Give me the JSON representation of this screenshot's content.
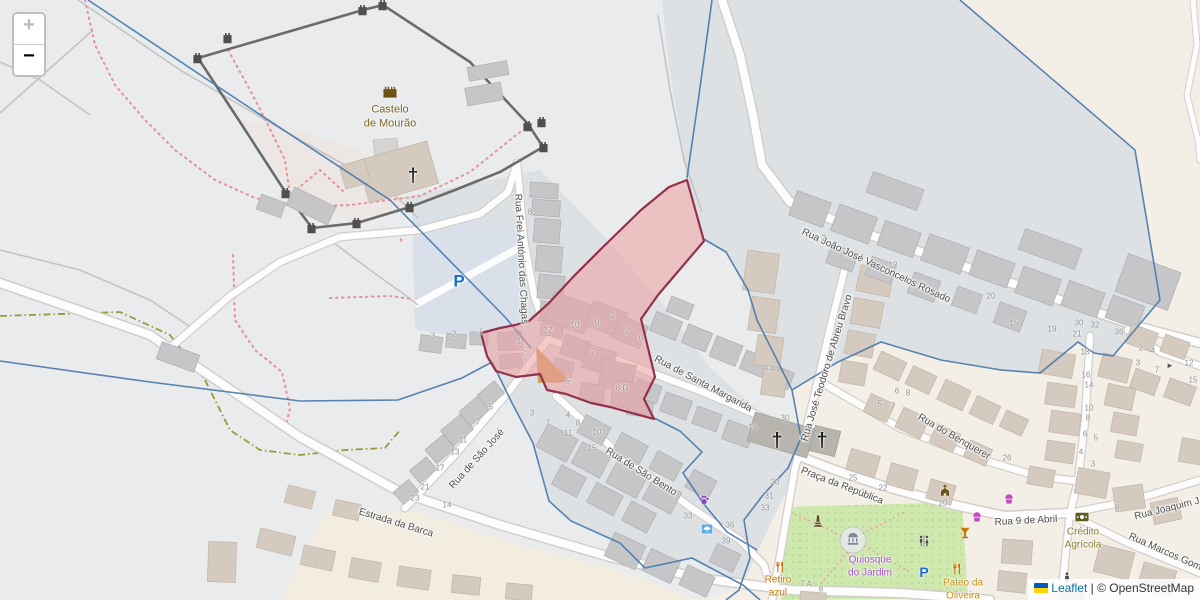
{
  "ui": {
    "controls": {
      "zoom_in": "+",
      "zoom_out": "−"
    },
    "attribution": {
      "leaflet": "Leaflet",
      "separator": " | ",
      "osm": "© OpenStreetMap",
      "flag_icon": "ukraine-flag-icon"
    }
  },
  "map": {
    "colors": {
      "selection_fill": "#ee9f9f",
      "selection_stroke": "#93304c",
      "boundary_blue": "#4a79ad",
      "park_green": "#cfe8ae",
      "road_white": "#fdfdfd",
      "landuse_gray": "#dde1e4",
      "landuse_cream": "#f4efe6"
    },
    "street_labels": [
      {
        "text": "Rua Frei António das Chagas",
        "x": 521,
        "y": 259,
        "rot": 87
      },
      {
        "text": "Rua de Santa Margarida",
        "x": 703,
        "y": 384,
        "rot": 28
      },
      {
        "text": "Rua João José Vasconcelos Rosado",
        "x": 876,
        "y": 266,
        "rot": 25
      },
      {
        "text": "Rua José Teodoro de Abreu Bravo",
        "x": 827,
        "y": 368,
        "rot": -73
      },
      {
        "text": "Rua do Benquerer",
        "x": 954,
        "y": 437,
        "rot": 30
      },
      {
        "text": "Rua de São José",
        "x": 477,
        "y": 459,
        "rot": -48
      },
      {
        "text": "Rua de São Bento",
        "x": 641,
        "y": 472,
        "rot": 32
      },
      {
        "text": "Estrada da Barca",
        "x": 396,
        "y": 523,
        "rot": 17
      },
      {
        "text": "Praça da República",
        "x": 842,
        "y": 486,
        "rot": 21
      },
      {
        "text": "Rua 9 de Abril",
        "x": 1026,
        "y": 521,
        "rot": -3
      },
      {
        "text": "Rua Joaquim J",
        "x": 1167,
        "y": 509,
        "rot": -14
      },
      {
        "text": "Rua Marcos Gom",
        "x": 1165,
        "y": 552,
        "rot": 24
      }
    ],
    "poi_labels": [
      {
        "name": "castle-label",
        "text": "Castelo\nde Mourão",
        "x": 390,
        "y": 117,
        "color": "#7b6428",
        "size": 11
      },
      {
        "name": "bank-label",
        "text": "Crédito\nAgrícola",
        "x": 1083,
        "y": 539,
        "color": "#8b7d33",
        "size": 10
      },
      {
        "name": "kiosk-label",
        "text": "Quiosque\ndo Jardim",
        "x": 870,
        "y": 567,
        "color": "#a050c8",
        "size": 10
      },
      {
        "name": "restaurant-label",
        "text": "Retiro\nazul",
        "x": 778,
        "y": 587,
        "color": "#c77400",
        "size": 10
      },
      {
        "name": "restaurant-label",
        "text": "Pateo da\nOliveira",
        "x": 963,
        "y": 590,
        "color": "#c98e13",
        "size": 10
      }
    ],
    "house_numbers": [
      {
        "t": "1",
        "x": 531,
        "y": 193
      },
      {
        "t": "8",
        "x": 530,
        "y": 212
      },
      {
        "t": "12",
        "x": 548,
        "y": 330
      },
      {
        "t": "10",
        "x": 575,
        "y": 325
      },
      {
        "t": "9",
        "x": 597,
        "y": 323
      },
      {
        "t": "1",
        "x": 613,
        "y": 315
      },
      {
        "t": "2",
        "x": 627,
        "y": 331
      },
      {
        "t": "6",
        "x": 641,
        "y": 338
      },
      {
        "t": "7",
        "x": 593,
        "y": 352
      },
      {
        "t": "5",
        "x": 568,
        "y": 381
      },
      {
        "t": "8 D",
        "x": 622,
        "y": 388
      },
      {
        "t": "1",
        "x": 519,
        "y": 341
      },
      {
        "t": "2",
        "x": 523,
        "y": 353
      },
      {
        "t": "3",
        "x": 433,
        "y": 336
      },
      {
        "t": "2",
        "x": 454,
        "y": 334
      },
      {
        "t": "1",
        "x": 481,
        "y": 332
      },
      {
        "t": "5",
        "x": 491,
        "y": 407
      },
      {
        "t": "7",
        "x": 478,
        "y": 422
      },
      {
        "t": "11",
        "x": 463,
        "y": 440
      },
      {
        "t": "13",
        "x": 455,
        "y": 452
      },
      {
        "t": "17",
        "x": 440,
        "y": 468
      },
      {
        "t": "21",
        "x": 425,
        "y": 487
      },
      {
        "t": "23",
        "x": 415,
        "y": 498
      },
      {
        "t": "14",
        "x": 447,
        "y": 505
      },
      {
        "t": "3",
        "x": 532,
        "y": 413
      },
      {
        "t": "7",
        "x": 548,
        "y": 423
      },
      {
        "t": "4",
        "x": 568,
        "y": 415
      },
      {
        "t": "8",
        "x": 578,
        "y": 423
      },
      {
        "t": "11",
        "x": 568,
        "y": 433
      },
      {
        "t": "10",
        "x": 597,
        "y": 432
      },
      {
        "t": "15",
        "x": 592,
        "y": 448
      },
      {
        "t": "33",
        "x": 688,
        "y": 516
      },
      {
        "t": "36",
        "x": 730,
        "y": 525
      },
      {
        "t": "39",
        "x": 726,
        "y": 541
      },
      {
        "t": "30",
        "x": 775,
        "y": 482
      },
      {
        "t": "31",
        "x": 769,
        "y": 496
      },
      {
        "t": "33",
        "x": 765,
        "y": 508
      },
      {
        "t": "30",
        "x": 785,
        "y": 418
      },
      {
        "t": "15",
        "x": 753,
        "y": 427
      },
      {
        "t": "2",
        "x": 824,
        "y": 238
      },
      {
        "t": "12",
        "x": 893,
        "y": 265
      },
      {
        "t": "20",
        "x": 991,
        "y": 296
      },
      {
        "t": "15",
        "x": 1014,
        "y": 323
      },
      {
        "t": "19",
        "x": 1052,
        "y": 329
      },
      {
        "t": "30",
        "x": 1079,
        "y": 323
      },
      {
        "t": "32",
        "x": 1095,
        "y": 325
      },
      {
        "t": "21",
        "x": 1077,
        "y": 334
      },
      {
        "t": "36",
        "x": 1119,
        "y": 332
      },
      {
        "t": "2",
        "x": 1141,
        "y": 348
      },
      {
        "t": "4",
        "x": 1153,
        "y": 351
      },
      {
        "t": "3",
        "x": 1138,
        "y": 363
      },
      {
        "t": "7",
        "x": 1157,
        "y": 370
      },
      {
        "t": "12",
        "x": 1189,
        "y": 363
      },
      {
        "t": "15",
        "x": 1193,
        "y": 380
      },
      {
        "t": "18",
        "x": 1085,
        "y": 352
      },
      {
        "t": "16",
        "x": 1086,
        "y": 375
      },
      {
        "t": "14",
        "x": 1089,
        "y": 385
      },
      {
        "t": "10",
        "x": 1089,
        "y": 408
      },
      {
        "t": "8",
        "x": 1088,
        "y": 418
      },
      {
        "t": "6",
        "x": 1085,
        "y": 434
      },
      {
        "t": "5",
        "x": 1096,
        "y": 438
      },
      {
        "t": "4",
        "x": 1081,
        "y": 452
      },
      {
        "t": "3",
        "x": 1093,
        "y": 464
      },
      {
        "t": "6",
        "x": 897,
        "y": 391
      },
      {
        "t": "8",
        "x": 908,
        "y": 393
      },
      {
        "t": "5",
        "x": 880,
        "y": 404
      },
      {
        "t": "7",
        "x": 893,
        "y": 406
      },
      {
        "t": "26",
        "x": 1007,
        "y": 458
      },
      {
        "t": "25",
        "x": 853,
        "y": 478
      },
      {
        "t": "22",
        "x": 883,
        "y": 488
      },
      {
        "t": "20",
        "x": 943,
        "y": 503
      },
      {
        "t": "7 A",
        "x": 806,
        "y": 584
      },
      {
        "t": "8",
        "x": 821,
        "y": 589
      },
      {
        "t": "8",
        "x": 1117,
        "y": 508
      }
    ],
    "icons": [
      {
        "name": "castle-icon",
        "x": 390,
        "y": 91,
        "sym": "castle",
        "color": "#6d5118",
        "s": 15
      },
      {
        "name": "church-cross-icon",
        "x": 413,
        "y": 176,
        "kind": "text",
        "glyph": "†",
        "color": "#2a2a2a",
        "s": 19
      },
      {
        "name": "church-cross-icon",
        "x": 777,
        "y": 441,
        "kind": "text",
        "glyph": "†",
        "color": "#1f1f1f",
        "s": 20
      },
      {
        "name": "church-cross-icon",
        "x": 822,
        "y": 441,
        "kind": "text",
        "glyph": "†",
        "color": "#1f1f1f",
        "s": 20
      },
      {
        "name": "parking-icon",
        "x": 459,
        "y": 281,
        "kind": "text",
        "glyph": "P",
        "color": "#1a6fc4",
        "s": 17
      },
      {
        "name": "parking-icon",
        "x": 924,
        "y": 572,
        "kind": "text",
        "glyph": "P",
        "color": "#1a6fc4",
        "s": 14
      },
      {
        "name": "shelter-icon",
        "x": 707,
        "y": 529,
        "sym": "shelter",
        "color": "#58aee0",
        "s": 12
      },
      {
        "name": "paw-icon",
        "x": 704,
        "y": 500,
        "sym": "paw",
        "color": "#8b44c3",
        "s": 12
      },
      {
        "name": "monument-icon",
        "x": 818,
        "y": 521,
        "sym": "monument",
        "color": "#5c4a1e",
        "s": 13
      },
      {
        "name": "fountain-icon",
        "x": 853,
        "y": 539,
        "sym": "fountain",
        "color": "#7b8a99",
        "s": 14
      },
      {
        "name": "toilets-icon",
        "x": 924,
        "y": 541,
        "sym": "toilets",
        "color": "#4f4f4f",
        "s": 13
      },
      {
        "name": "restaurant-icon",
        "x": 780,
        "y": 567,
        "sym": "fork",
        "color": "#c77400",
        "s": 12
      },
      {
        "name": "restaurant-icon",
        "x": 957,
        "y": 569,
        "sym": "fork",
        "color": "#c77400",
        "s": 12
      },
      {
        "name": "bar-icon",
        "x": 965,
        "y": 533,
        "sym": "glass",
        "color": "#c77400",
        "s": 12
      },
      {
        "name": "bakery-icon",
        "x": 977,
        "y": 516,
        "sym": "bakery",
        "color": "#c04cc0",
        "s": 12
      },
      {
        "name": "bakery-icon",
        "x": 1009,
        "y": 498,
        "sym": "bakery",
        "color": "#c04cc0",
        "s": 12
      },
      {
        "name": "bank-icon",
        "x": 1082,
        "y": 517,
        "sym": "bank",
        "color": "#5f5c22",
        "s": 15
      },
      {
        "name": "church-icon",
        "x": 945,
        "y": 490,
        "sym": "church",
        "color": "#6d5118",
        "s": 13
      },
      {
        "name": "statue-icon",
        "x": 1067,
        "y": 577,
        "sym": "person",
        "color": "#4a4a4a",
        "s": 11
      },
      {
        "name": "oneway-arrow-icon",
        "x": 1170,
        "y": 366,
        "kind": "text",
        "glyph": "►",
        "color": "#555555",
        "s": 8
      }
    ]
  }
}
